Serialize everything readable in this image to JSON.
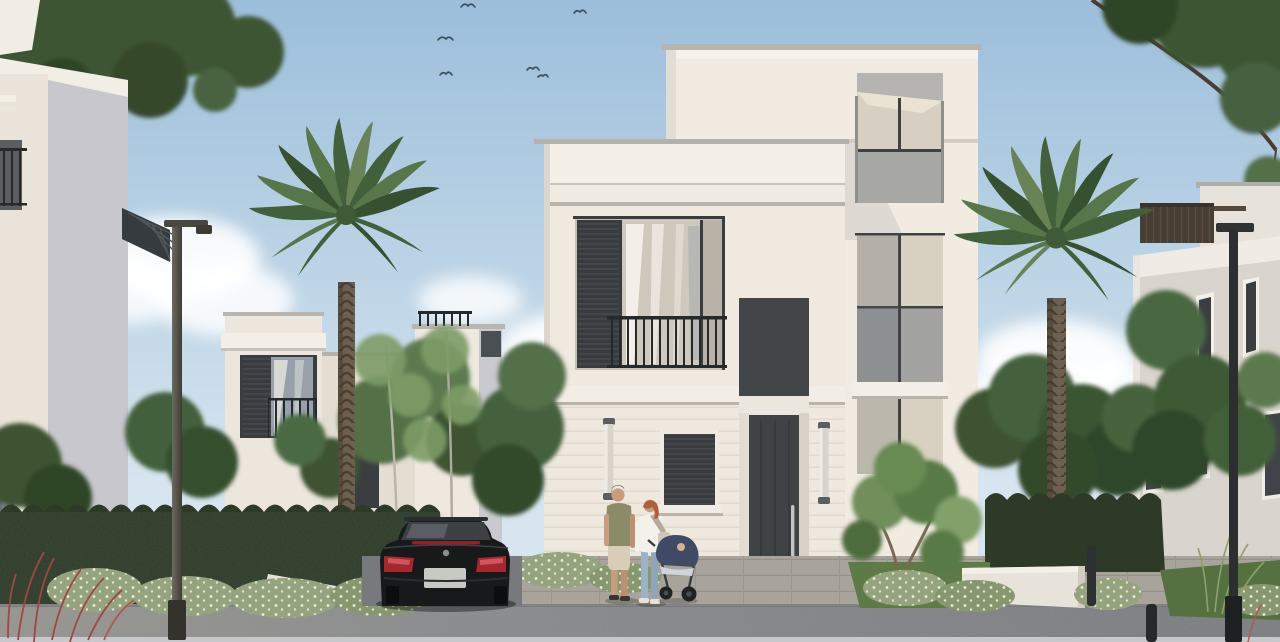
{
  "scene": {
    "description": "Photorealistic exterior render of a modern three-storey white villa community: central villa with dark entry door and steps, flanking white villas, two tall palm trees, dense green hedges, a parked black sedan, a couple walking with a baby stroller on the sidewalk, street lamps and bollards along the road, birds in a light blue sky",
    "objects": {
      "main_villa": {
        "storeys": 3,
        "features": [
          "rooftop parapet",
          "awning window",
          "glazed window strip",
          "shuttered balcony window",
          "wrought-iron balcony railing",
          "two wall sconces",
          "louvered ground window",
          "dark entry door with steel handle",
          "three entry steps"
        ]
      },
      "left_villas": 2,
      "right_villa": {
        "features": [
          "rooftop pergola",
          "tall narrow windows"
        ]
      },
      "palm_trees": 2,
      "street_lamps": 2,
      "bollards": 2,
      "car": {
        "type": "sedan",
        "color": "black",
        "view": "rear"
      },
      "people": [
        "man in olive t-shirt and beige shorts",
        "woman in white top and blue jeans",
        "baby in navy stroller"
      ],
      "birds": 6,
      "vegetation": [
        "dark hedges",
        "white flowering shrubs",
        "ornamental garden tree",
        "red fountain grass",
        "background trees"
      ]
    }
  },
  "palette": {
    "sky_top": "#9cbedb",
    "sky_low": "#d6e5ef",
    "cloud": "#ffffff",
    "wall_light": "#f1ebe2",
    "wall_warm": "#efe9e0",
    "wall_shadow": "#c7c7cd",
    "wall_gray": "#d9d4cd",
    "cornice": "#f4f0e8",
    "cap_gray": "#b3b0aa",
    "glass_cream": "#d8d1c1",
    "spandrel_gray": "#a3a4a1",
    "glass_dark": "#3c4045",
    "shutter": "#383c3f",
    "door": "#3f4346",
    "handle": "#c2c5c7",
    "recess": "#4c4f51",
    "hedge": "#2c3a27",
    "foliage_dark": "#3c5233",
    "foliage_mid": "#527046",
    "foliage_light": "#7d9c66",
    "palm_green": "#4f6e44",
    "palm_dark": "#3a5733",
    "trunk": "#6e604e",
    "lawn": "#5d7a47",
    "sidewalk": "#a8a39b",
    "road": "#828487",
    "curb": "#c7c8c9",
    "drive": "#77797c",
    "car_body": "#17191b",
    "taillight": "#a52830",
    "plate": "#c8c8c4",
    "skin": "#c99c7e",
    "shirt_olive": "#8b8b67",
    "shorts_beige": "#d8cdb6",
    "top_white": "#f3f1eb",
    "jeans_blue": "#9db3c5",
    "hair_orange": "#b06038",
    "stroller_navy": "#3e4a66",
    "lamp_dark": "#2c2e30",
    "bush_light": "#95a37f",
    "flower": "#e9eedb",
    "red_grass": "#a34545",
    "awning": "#b5b4b0"
  }
}
